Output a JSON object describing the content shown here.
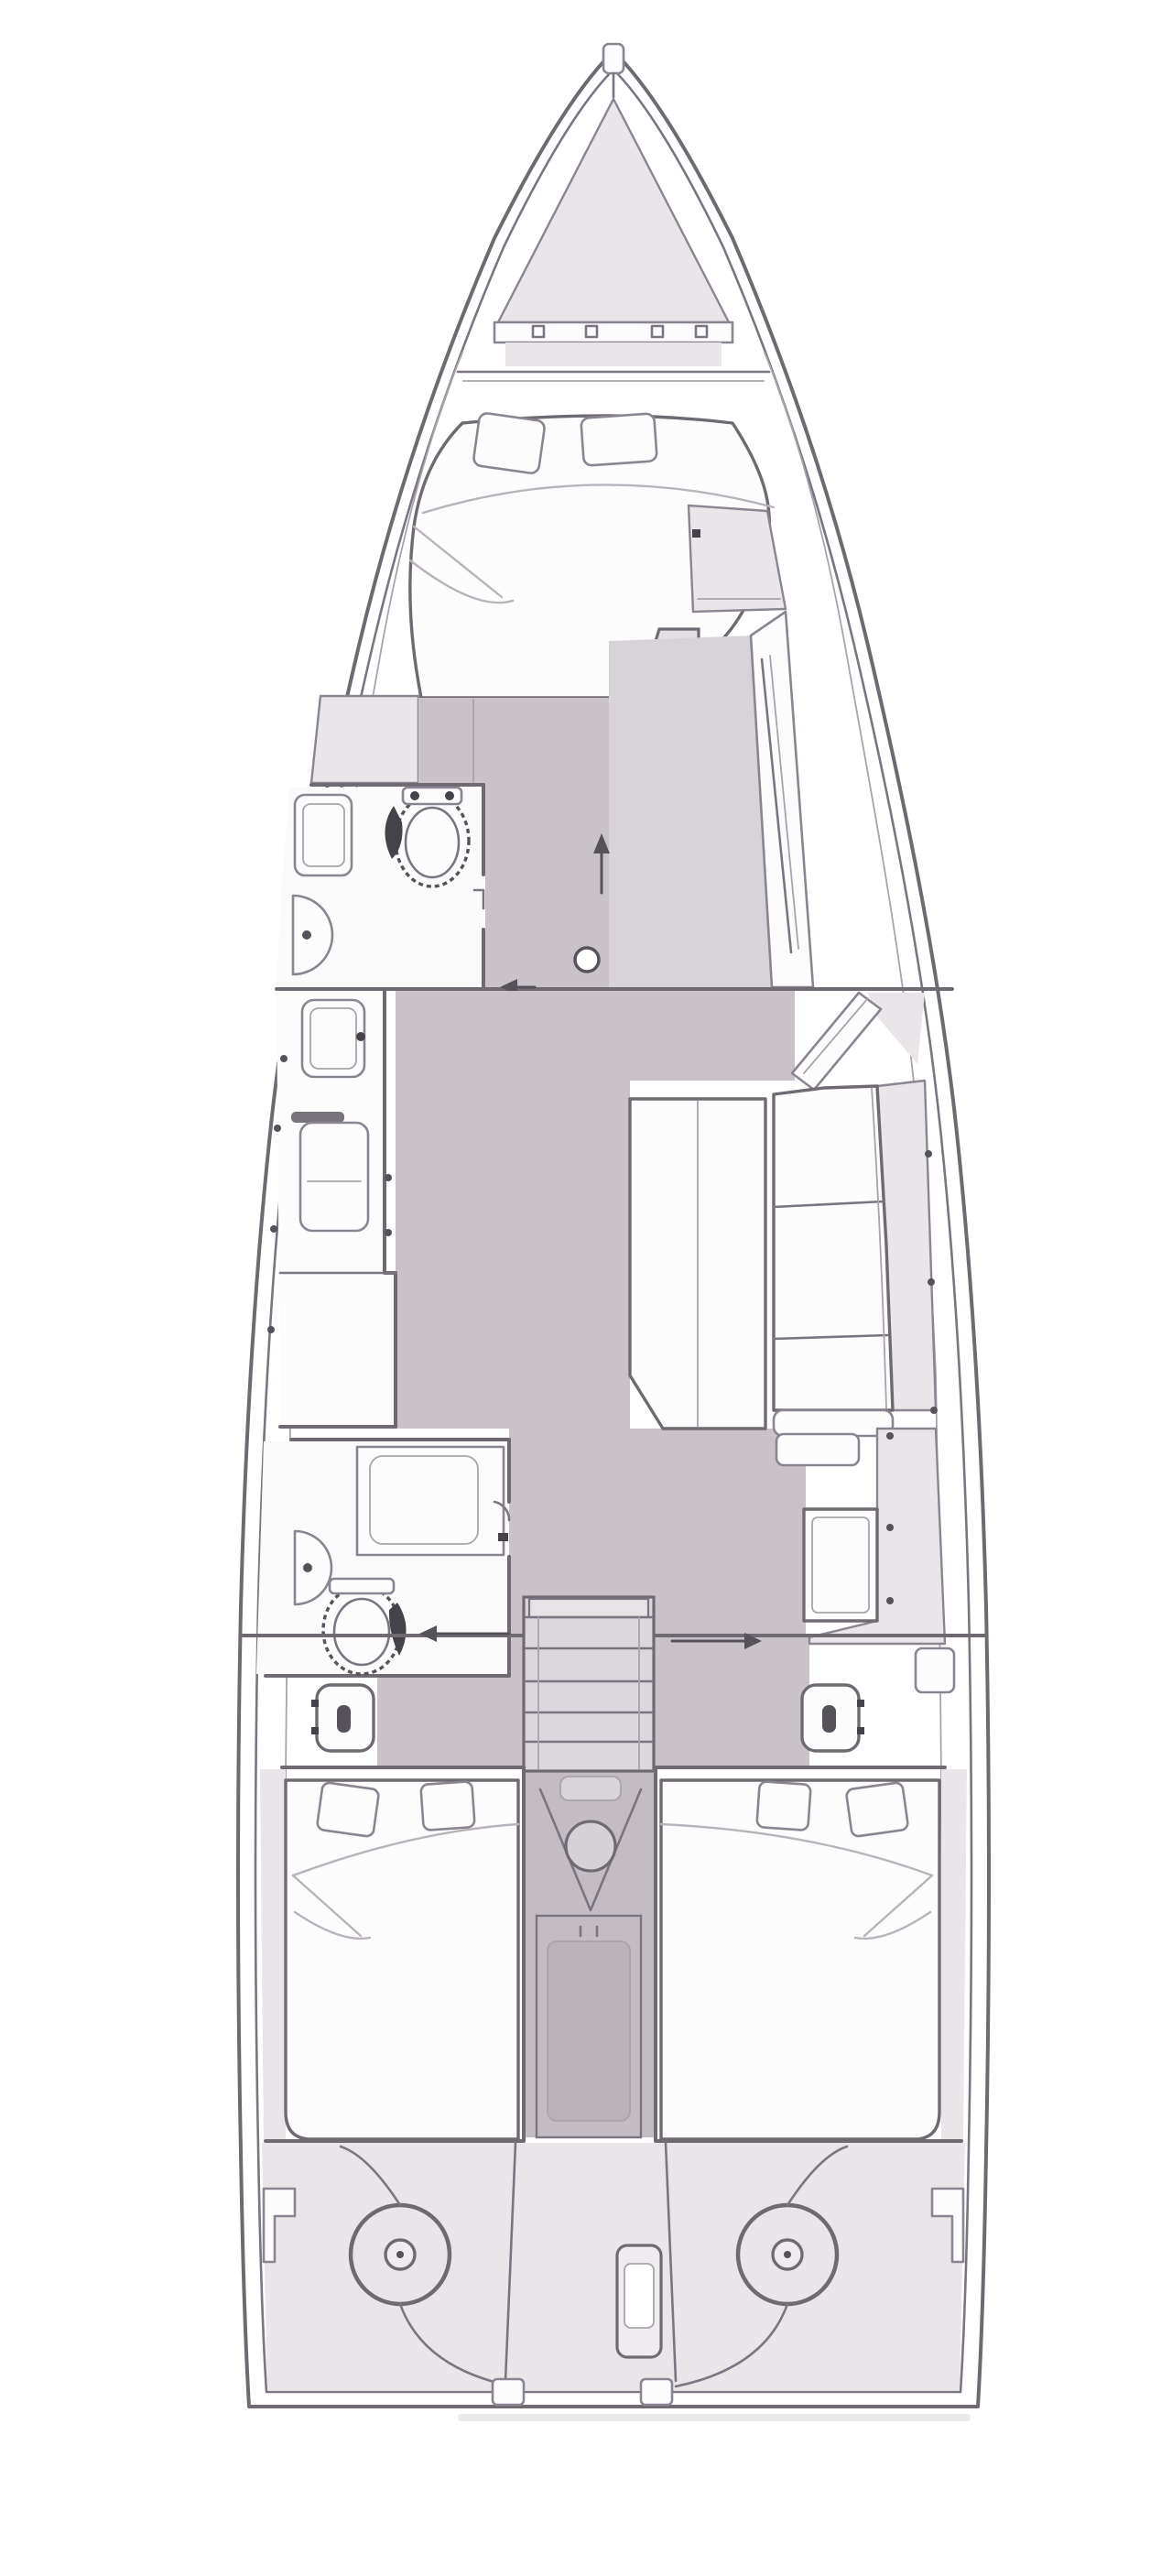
{
  "page": {
    "title": "Sailing yacht interior layout plan (top view, bow up)"
  },
  "diagram": {
    "kind": "boat-floorplan",
    "orientation": "bow-at-top",
    "areas": [
      {
        "id": "bow-anchor-locker",
        "label": "anchor locker with windlass hatch"
      },
      {
        "id": "forward-cabin",
        "label": "forward cabin",
        "features": [
          "double berth",
          "2 pillows",
          "hanging lockers",
          "dressing area"
        ]
      },
      {
        "id": "forward-head",
        "label": "forward head",
        "features": [
          "toilet",
          "sink",
          "round shower basin"
        ]
      },
      {
        "id": "corridor",
        "label": "central corridor",
        "features": [
          "mast post ring",
          "forward direction arrow",
          "port direction arrow"
        ]
      },
      {
        "id": "galley",
        "label": "galley on port side",
        "features": [
          "sink",
          "fridge with handle",
          "counter divider"
        ]
      },
      {
        "id": "salon",
        "label": "salon on starboard side",
        "features": [
          "L settee with chaise",
          "3 seat cushions",
          "folding dining table"
        ]
      },
      {
        "id": "aft-head",
        "label": "aft head",
        "features": [
          "shower stall",
          "toilet",
          "half-round sink"
        ]
      },
      {
        "id": "nav-station",
        "label": "navigation station",
        "features": [
          "chart table",
          "bench",
          "side locker"
        ]
      },
      {
        "id": "companionway",
        "label": "companionway stairs",
        "features": [
          "5 treads",
          "engine compartment circle",
          "V engine cover"
        ]
      },
      {
        "id": "aft-cabin-port",
        "label": "port aft cabin",
        "features": [
          "double berth",
          "2 pillows",
          "hull shelf"
        ]
      },
      {
        "id": "aft-cabin-starboard",
        "label": "starboard aft cabin",
        "features": [
          "double berth",
          "2 pillows",
          "hull shelf"
        ]
      },
      {
        "id": "cockpit-transom",
        "label": "transom helm area",
        "features": [
          "twin steering wheels",
          "center pedestal",
          "2 corner steps",
          "2 winches"
        ]
      }
    ],
    "counts": {
      "cabins": 3,
      "heads": 2,
      "helm_wheels": 2,
      "winches": 2,
      "stair_treads": 5,
      "pillows": 6
    }
  },
  "colors": {
    "background": "#ffffff",
    "deck_white": "#ffffff",
    "hull_shell": "#e9e5e9",
    "floor": "#c9c3c9",
    "floor_secondary": "#d8d3d8",
    "stairs_fill": "#dcd7dc",
    "engine_column": "#c3bdc3",
    "engine_column_inner": "#b9b3b9",
    "furniture_white": "#fdfcfd",
    "wall_line": "#6f6a72",
    "furniture_line": "#8a8590",
    "detail_line": "#a9a3ab",
    "dark_accent": "#45424a",
    "shadow": "#e2dee2"
  }
}
